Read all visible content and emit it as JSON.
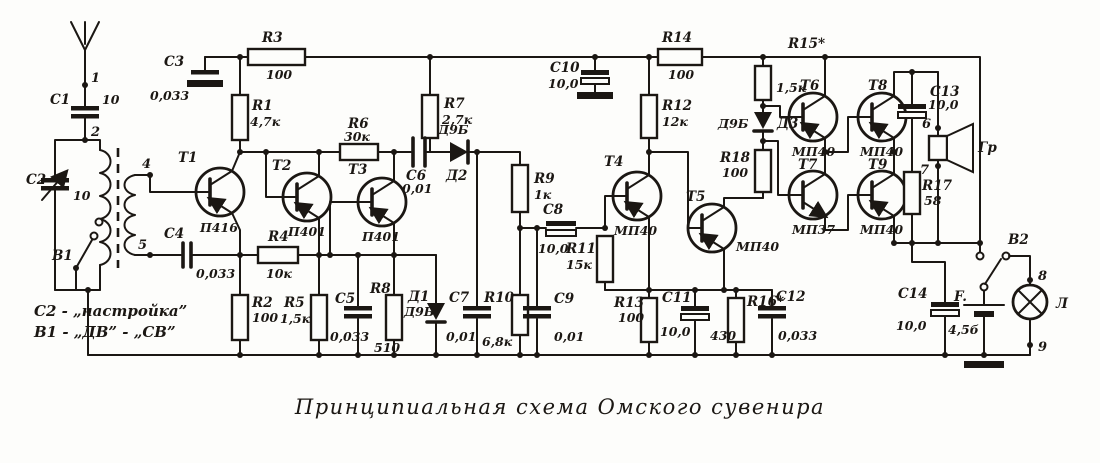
{
  "caption": "Принципиальная схема Омского сувенира",
  "notes": {
    "line1": "C2 - „настройка”",
    "line2": "B1 - „ДВ” - „СВ”"
  },
  "nodes": {
    "n1": "1",
    "n2": "2",
    "n4": "4",
    "n5": "5",
    "n6": "6",
    "n7": "7",
    "n8": "8",
    "n9": "9"
  },
  "components": {
    "c1": {
      "ref": "C1",
      "val": "10"
    },
    "c2": {
      "ref": "C2",
      "val": "10"
    },
    "b1": {
      "ref": "B1"
    },
    "c3": {
      "ref": "C3",
      "val": "0,033"
    },
    "c4": {
      "ref": "C4",
      "val": "0,033"
    },
    "c5": {
      "ref": "C5",
      "val": "0,033"
    },
    "c6": {
      "ref": "C6",
      "val": "0,01"
    },
    "c7": {
      "ref": "C7",
      "val": "0,01"
    },
    "c8": {
      "ref": "C8",
      "val": "10,0"
    },
    "c9": {
      "ref": "C9",
      "val": "0,01"
    },
    "c10": {
      "ref": "C10",
      "val": "10,0"
    },
    "c11": {
      "ref": "C11",
      "val": "10,0"
    },
    "c12": {
      "ref": "C12",
      "val": "0,033"
    },
    "c13": {
      "ref": "C13",
      "val": "10,0"
    },
    "c14": {
      "ref": "C14",
      "val": "10,0"
    },
    "r1": {
      "ref": "R1",
      "val": "4,7к"
    },
    "r2": {
      "ref": "R2",
      "val": "100"
    },
    "r3": {
      "ref": "R3",
      "val": "100"
    },
    "r4": {
      "ref": "R4",
      "val": "10к"
    },
    "r5": {
      "ref": "R5",
      "val": "1,5к"
    },
    "r6": {
      "ref": "R6",
      "val": "30к"
    },
    "r7": {
      "ref": "R7",
      "val": "2,7к"
    },
    "r8": {
      "ref": "R8",
      "val": "510"
    },
    "r9": {
      "ref": "R9",
      "val": "1к"
    },
    "r10": {
      "ref": "R10",
      "val": "6,8к"
    },
    "r11": {
      "ref": "R11",
      "val": "15к"
    },
    "r12": {
      "ref": "R12",
      "val": "12к"
    },
    "r13": {
      "ref": "R13",
      "val": "100"
    },
    "r14": {
      "ref": "R14",
      "val": "100"
    },
    "r15": {
      "ref": "R15*",
      "val": "1,5к"
    },
    "r16": {
      "ref": "R16*",
      "val": "430"
    },
    "r17": {
      "ref": "R17",
      "val": "58"
    },
    "r18": {
      "ref": "R18",
      "val": "100"
    },
    "d1": {
      "ref": "Д1",
      "val": "Д9Б"
    },
    "d2": {
      "ref": "Д2",
      "val": "Д9Б"
    },
    "d3": {
      "ref": "Д3",
      "val": "Д9Б"
    },
    "t1": {
      "ref": "T1",
      "val": "П416"
    },
    "t2": {
      "ref": "T2",
      "val": "П401"
    },
    "t3": {
      "ref": "T3",
      "val": "П401"
    },
    "t4": {
      "ref": "T4",
      "val": "МП40"
    },
    "t5": {
      "ref": "T5",
      "val": "МП40"
    },
    "t6": {
      "ref": "T6",
      "val": "МП40"
    },
    "t7": {
      "ref": "T7",
      "val": "МП37"
    },
    "t8": {
      "ref": "T8",
      "val": "МП40"
    },
    "t9": {
      "ref": "T9",
      "val": "МП40"
    },
    "speaker": {
      "ref": "Гр"
    },
    "battery": {
      "ref": "F.",
      "val": "4,5б"
    },
    "b2": {
      "ref": "B2"
    },
    "lamp": {
      "ref": "Л"
    }
  },
  "ink_color": "#1b1713",
  "paper_color": "#fdfdfb"
}
